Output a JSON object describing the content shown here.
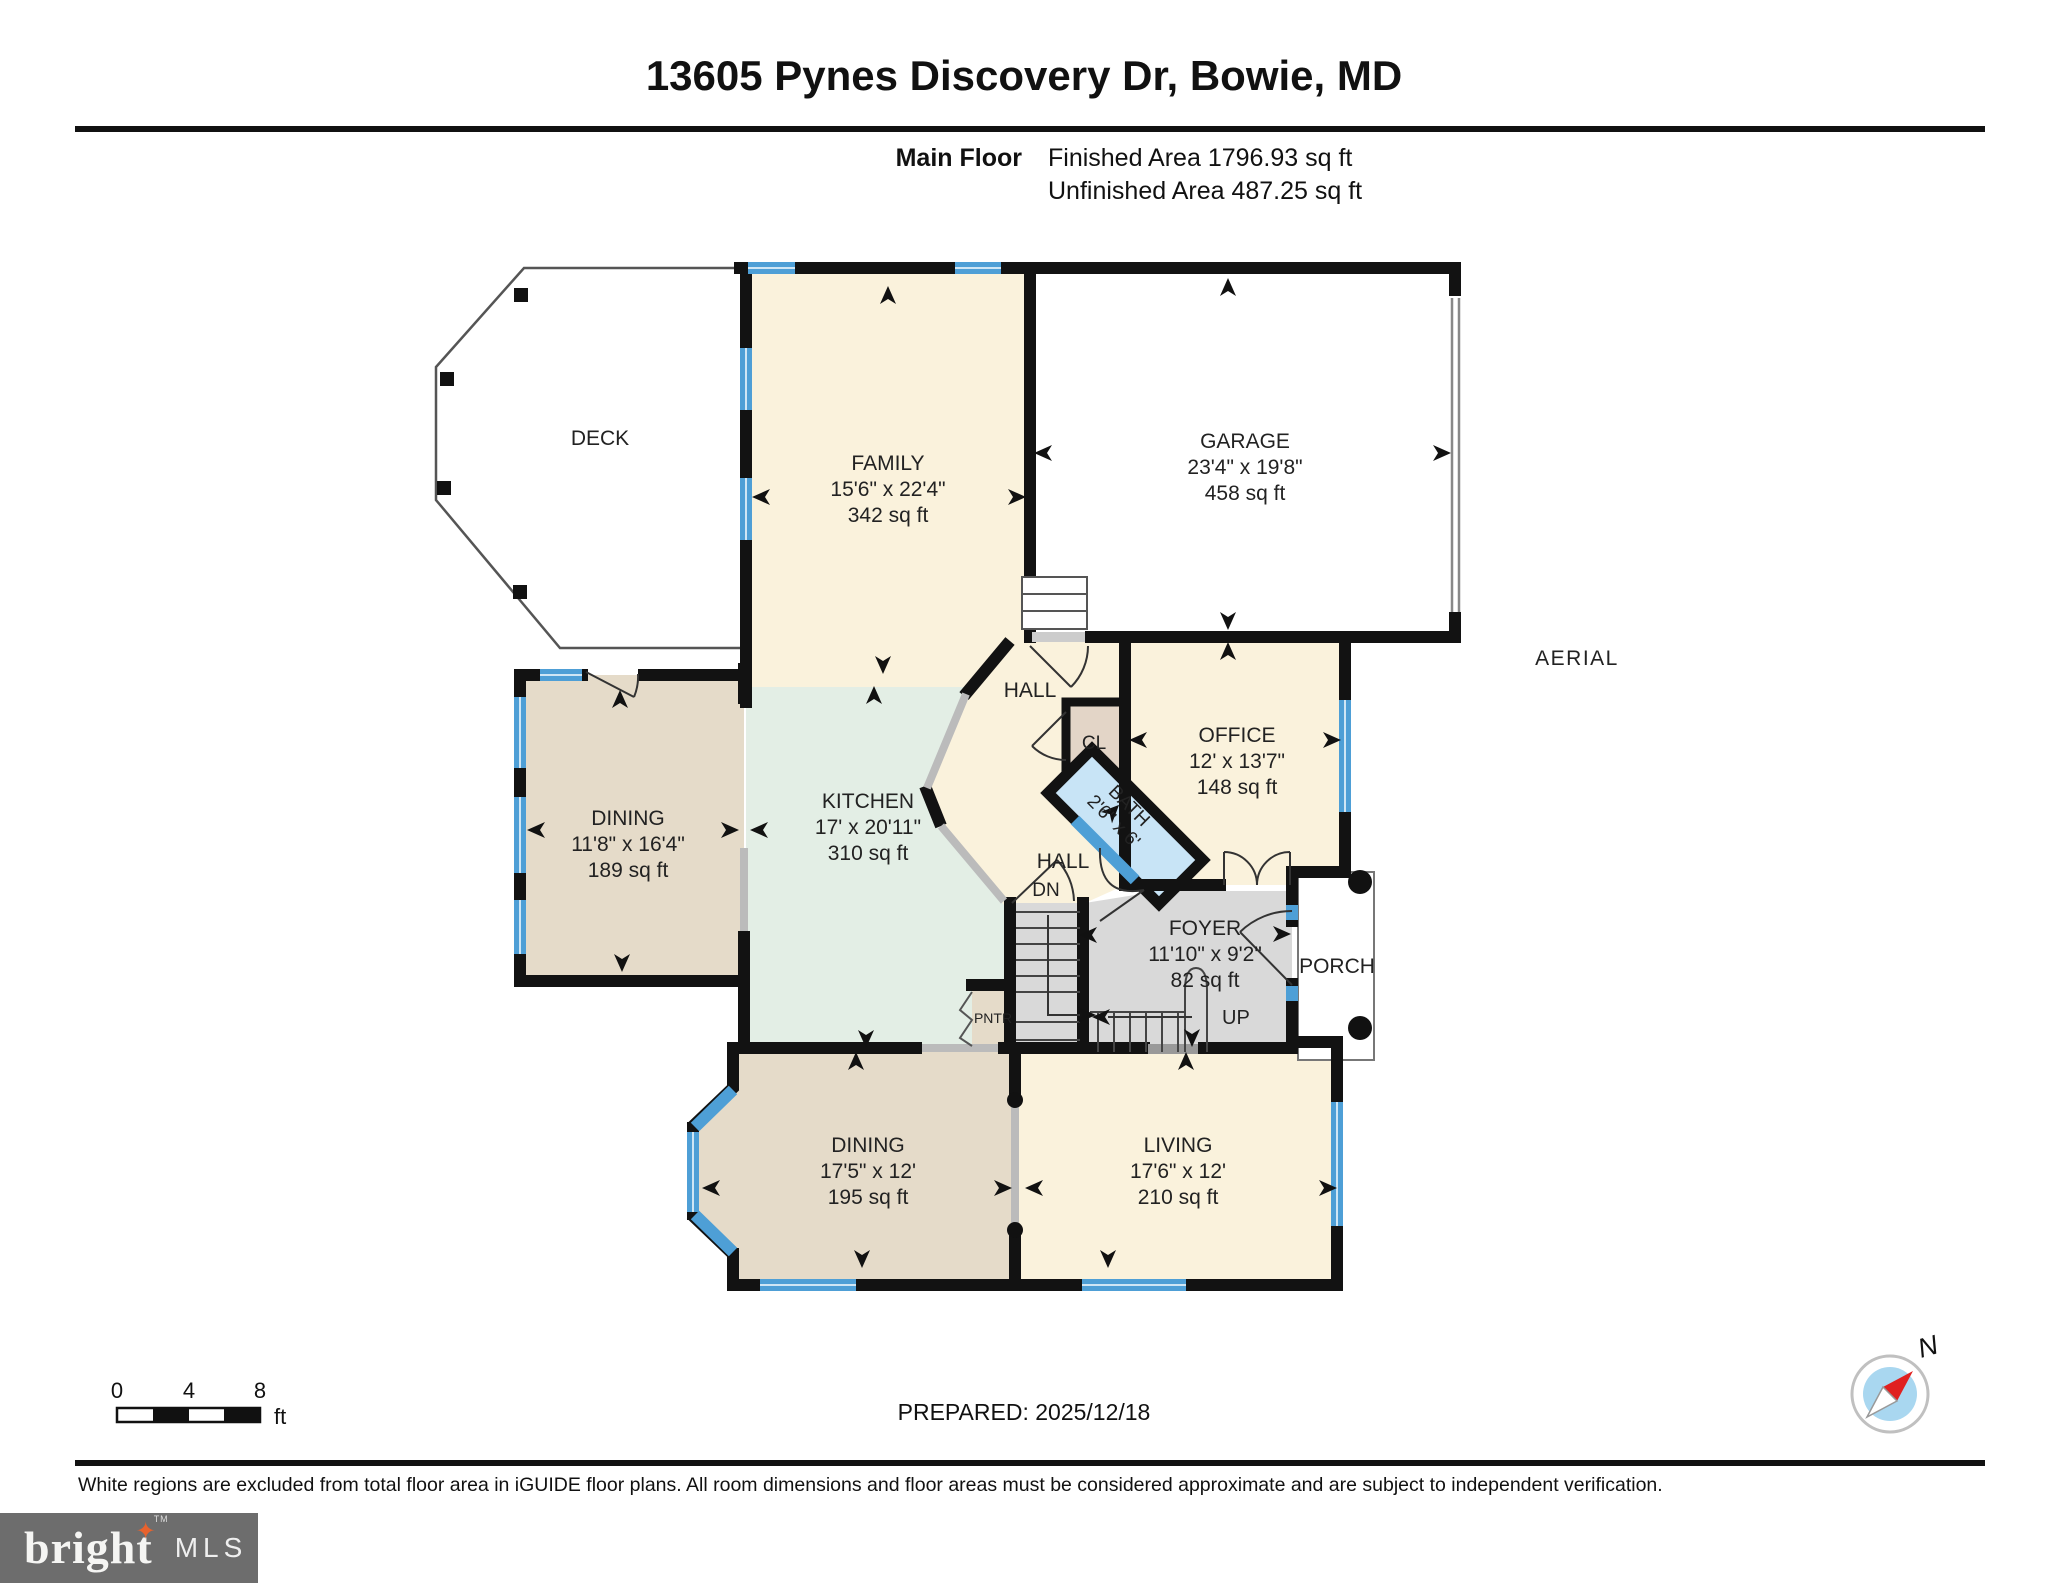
{
  "header": {
    "title": "13605 Pynes Discovery Dr, Bowie, MD",
    "floor_label": "Main Floor",
    "finished_area": "Finished Area 1796.93 sq ft",
    "unfinished_area": "Unfinished Area 487.25 sq ft"
  },
  "plan": {
    "deck": {
      "name": "DECK"
    },
    "family": {
      "name": "FAMILY",
      "dims": "15'6\" x 22'4\"",
      "area": "342 sq ft"
    },
    "garage": {
      "name": "GARAGE",
      "dims": "23'4\" x 19'8\"",
      "area": "458 sq ft"
    },
    "dining_upper": {
      "name": "DINING",
      "dims": "11'8\" x 16'4\"",
      "area": "189 sq ft"
    },
    "kitchen": {
      "name": "KITCHEN",
      "dims": "17' x 20'11\"",
      "area": "310 sq ft"
    },
    "hall_upper": {
      "name": "HALL"
    },
    "closet": {
      "name": "CL"
    },
    "office": {
      "name": "OFFICE",
      "dims": "12' x 13'7\"",
      "area": "148 sq ft"
    },
    "bath": {
      "name": "BATH",
      "dims": "2'6\" x 6'"
    },
    "hall_lower": {
      "name": "HALL"
    },
    "stair_down_label": "DN",
    "stair_up_label": "UP",
    "foyer": {
      "name": "FOYER",
      "dims": "11'10\" x 9'2\"",
      "area": "82 sq ft"
    },
    "porch": {
      "name": "PORCH"
    },
    "pantry": {
      "name": "PNTR"
    },
    "dining_lower": {
      "name": "DINING",
      "dims": "17'5\" x 12'",
      "area": "195 sq ft"
    },
    "living": {
      "name": "LIVING",
      "dims": "17'6\" x 12'",
      "area": "210 sq ft"
    },
    "aerial_label": "AERIAL"
  },
  "scale_bar": {
    "ticks": [
      "0",
      "4",
      "8"
    ],
    "unit": "ft"
  },
  "compass": {
    "label": "N"
  },
  "footer": {
    "prepared": "PREPARED: 2025/12/18",
    "disclaimer": "White regions are excluded from total floor area in iGUIDE floor plans. All room dimensions and floor areas must be considered approximate and are subject to independent verification."
  },
  "logo": {
    "word": "bright",
    "star": "✦",
    "tm": "TM",
    "suffix": "MLS"
  },
  "colors": {
    "finished_cream": "#FAF2DC",
    "kitchen_mint": "#E3EEE5",
    "dining_tan": "#E5DBC9",
    "closet_tan": "#E3D5C7",
    "foyer_gray": "#D9D9D9",
    "bath_blue": "#C8E4F6",
    "window_blue": "#4E9FD6",
    "wall_black": "#121212",
    "logo_gray": "#6D6D6D",
    "logo_star_orange": "#E8622D"
  }
}
